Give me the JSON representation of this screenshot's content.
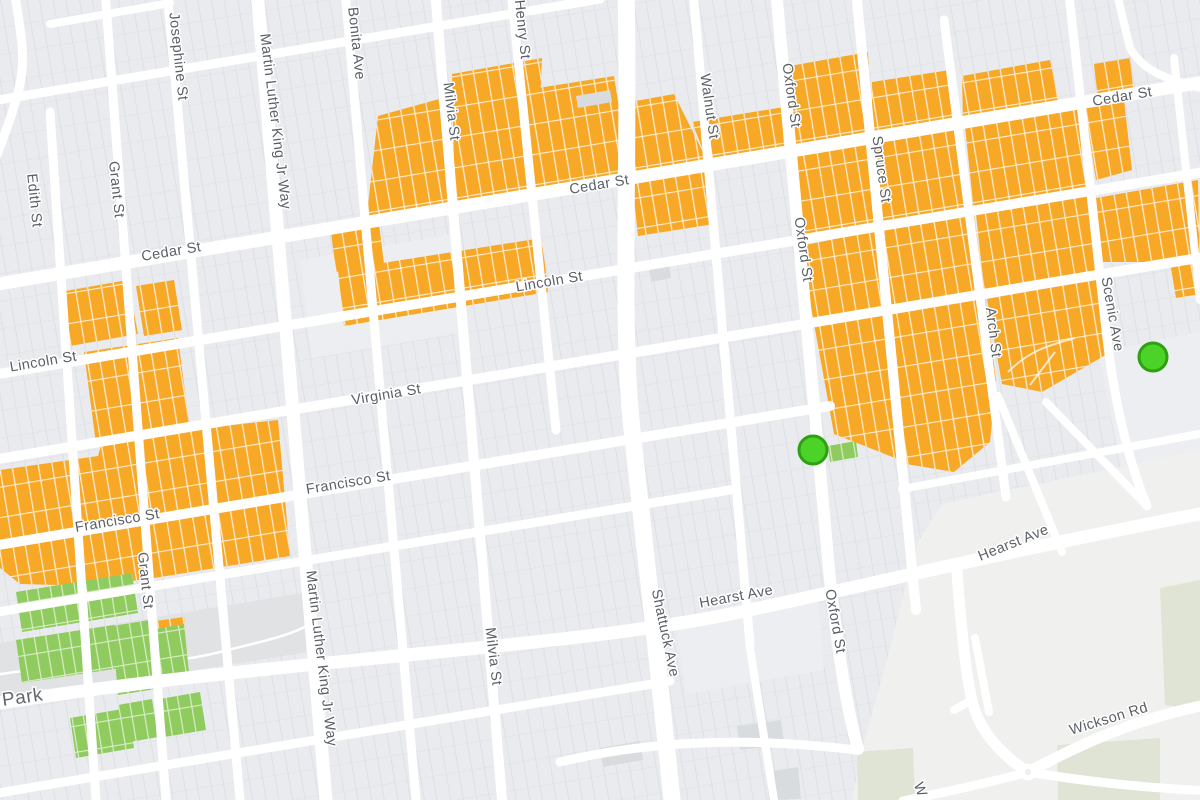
{
  "map": {
    "background_color": "#eef0f3",
    "block_color": "#e9ebee",
    "parcel_line_color": "#dde0e5",
    "street_color": "#ffffff",
    "plain_block_color": "#edeef1",
    "campus_color": "#f0f1ee",
    "campus_green_color": "#dfe4d4",
    "park_band_color": "#e0e2e3",
    "building_color": "#d9dcdf",
    "label_color": "#5b6066",
    "area_label_color": "#62666c",
    "zones": {
      "orange_highlight": {
        "name": "highlighted-parcels-orange",
        "fill": "#F7A827",
        "divider": "rgba(255,255,255,0.78)"
      },
      "green_highlight": {
        "name": "highlighted-parcels-green",
        "fill": "#90CB5F",
        "divider": "rgba(255,255,255,0.65)"
      }
    },
    "markers": [
      {
        "name": "green-circle-marker",
        "x": 813,
        "y": 450,
        "radius": 14,
        "fill": "#4BD327",
        "stroke": "#2FA012",
        "stroke_width": 3
      },
      {
        "name": "green-circle-marker",
        "x": 1153,
        "y": 357,
        "radius": 14,
        "fill": "#4BD327",
        "stroke": "#2FA012",
        "stroke_width": 3
      }
    ],
    "street_labels": [
      {
        "text": "Josephine St",
        "x": 174,
        "y": 57,
        "angle": 84,
        "size": 14.5
      },
      {
        "text": "Martin Luther King Jr Way",
        "x": 271,
        "y": 122,
        "angle": 83,
        "size": 14.5
      },
      {
        "text": "Martin Luther King Jr Way",
        "x": 317,
        "y": 659,
        "angle": 83,
        "size": 14.5
      },
      {
        "text": "Edith St",
        "x": 30,
        "y": 201,
        "angle": 84,
        "size": 14.5
      },
      {
        "text": "Grant St",
        "x": 112,
        "y": 190,
        "angle": 84,
        "size": 14.5
      },
      {
        "text": "Grant St",
        "x": 141,
        "y": 581,
        "angle": 84,
        "size": 14.5
      },
      {
        "text": "Bonita Ave",
        "x": 352,
        "y": 44,
        "angle": 84,
        "size": 14.5
      },
      {
        "text": "Milvia St",
        "x": 447,
        "y": 112,
        "angle": 83,
        "size": 14.5
      },
      {
        "text": "Milvia St",
        "x": 489,
        "y": 657,
        "angle": 83,
        "size": 14.5
      },
      {
        "text": "Henry St",
        "x": 518,
        "y": 30,
        "angle": 84,
        "size": 14.5
      },
      {
        "text": "Shattuck Ave",
        "x": 661,
        "y": 634,
        "angle": 78,
        "size": 14.5
      },
      {
        "text": "Walnut St",
        "x": 705,
        "y": 107,
        "angle": 82,
        "size": 14.5
      },
      {
        "text": "Oxford St",
        "x": 787,
        "y": 96,
        "angle": 82,
        "size": 14.5
      },
      {
        "text": "Oxford St",
        "x": 799,
        "y": 250,
        "angle": 82,
        "size": 14.5
      },
      {
        "text": "Oxford St",
        "x": 831,
        "y": 622,
        "angle": 80,
        "size": 14.5
      },
      {
        "text": "Spruce St",
        "x": 877,
        "y": 170,
        "angle": 82,
        "size": 14.5
      },
      {
        "text": "Arch St",
        "x": 989,
        "y": 333,
        "angle": 83,
        "size": 14.5
      },
      {
        "text": "Scenic Ave",
        "x": 1108,
        "y": 315,
        "angle": 80,
        "size": 14.5
      },
      {
        "text": "Cedar St",
        "x": 172,
        "y": 256,
        "angle": -9.5,
        "size": 14.5
      },
      {
        "text": "Cedar St",
        "x": 600,
        "y": 189,
        "angle": -9.5,
        "size": 14.5
      },
      {
        "text": "Cedar St",
        "x": 1123,
        "y": 101,
        "angle": -9.5,
        "size": 14.5
      },
      {
        "text": "Lincoln St",
        "x": 44,
        "y": 366,
        "angle": -9.5,
        "size": 14.5
      },
      {
        "text": "Lincoln St",
        "x": 550,
        "y": 286,
        "angle": -9.5,
        "size": 14.5
      },
      {
        "text": "Virginia St",
        "x": 387,
        "y": 399,
        "angle": -9.5,
        "size": 14.5
      },
      {
        "text": "Francisco St",
        "x": 118,
        "y": 525,
        "angle": -9.5,
        "size": 14.5
      },
      {
        "text": "Francisco St",
        "x": 349,
        "y": 487,
        "angle": -9.5,
        "size": 14.5
      },
      {
        "text": "Hearst Ave",
        "x": 737,
        "y": 601,
        "angle": -10.5,
        "size": 14.5
      },
      {
        "text": "Hearst Ave",
        "x": 1015,
        "y": 547,
        "angle": -22,
        "size": 14.5
      },
      {
        "text": "Wickson Rd",
        "x": 1110,
        "y": 723,
        "angle": -17,
        "size": 14.5
      },
      {
        "text": "W",
        "x": 916,
        "y": 791,
        "angle": 70,
        "size": 14.5
      }
    ],
    "area_labels": [
      {
        "text": "Park",
        "x": 3,
        "y": 706,
        "angle": -8,
        "size": 19
      }
    ]
  }
}
